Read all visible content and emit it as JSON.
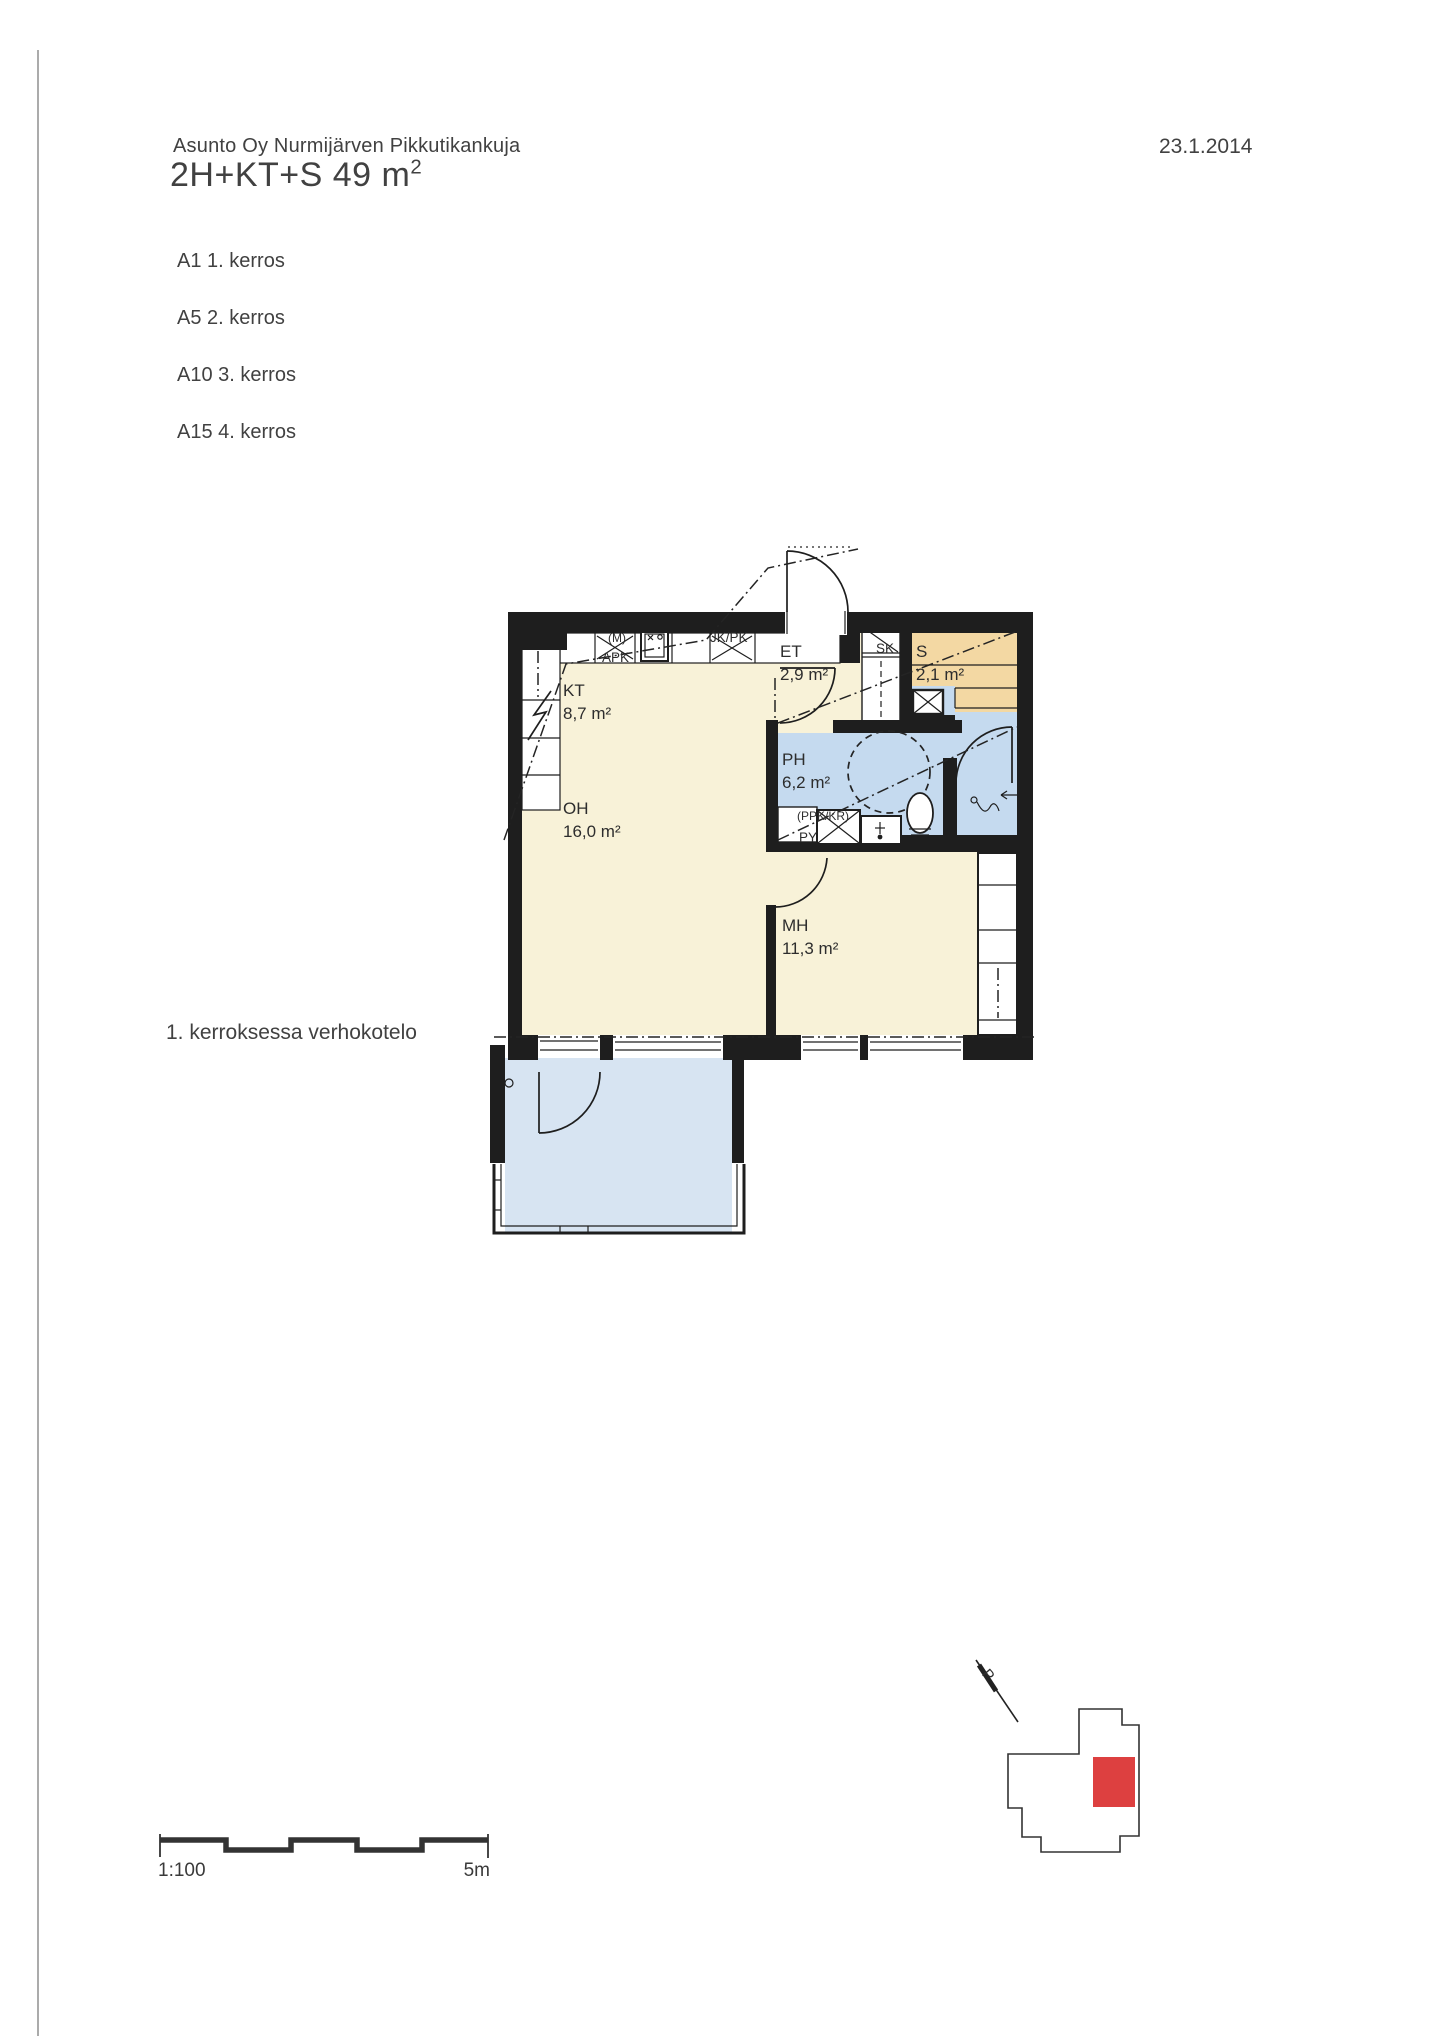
{
  "document": {
    "company": "Asunto Oy Nurmijärven Pikkutikankuja",
    "apartment_type": "2H+KT+S 49 m",
    "apartment_type_sup": "2",
    "date": "23.1.2014",
    "floor_list": [
      {
        "label": "A1 1. kerros"
      },
      {
        "label": "A5 2. kerros"
      },
      {
        "label": "A10 3. kerros"
      },
      {
        "label": "A15 4. kerros"
      }
    ],
    "note": "1. kerroksessa verhokotelo"
  },
  "floorplan": {
    "rooms": {
      "kt": {
        "abbr": "KT",
        "area": "8,7 m²"
      },
      "oh": {
        "abbr": "OH",
        "area": "16,0 m²"
      },
      "et": {
        "abbr": "ET",
        "area": "2,9 m²"
      },
      "sk": {
        "abbr": "SK"
      },
      "s": {
        "abbr": "S",
        "area": "2,1 m²"
      },
      "ph": {
        "abbr": "PH",
        "area": "6,2 m²"
      },
      "mh": {
        "abbr": "MH",
        "area": "11,3 m²"
      }
    },
    "fixture_labels": {
      "microwave": "(M)",
      "dishwasher": "APK",
      "fridge_freezer": "JK/PK",
      "washer_dryer": "(PPK/KR)",
      "laundry": "PY"
    },
    "colors": {
      "wall": "#1e1e1e",
      "dry_floor": "#f8f2d8",
      "wet_floor": "#c5daef",
      "sauna_floor": "#f3d8a3",
      "balcony_floor": "#d7e4f2"
    }
  },
  "scale_bar": {
    "ratio": "1:100",
    "length": "5m"
  },
  "site_map": {
    "north_label": "P",
    "highlight_color": "#dd4040"
  }
}
